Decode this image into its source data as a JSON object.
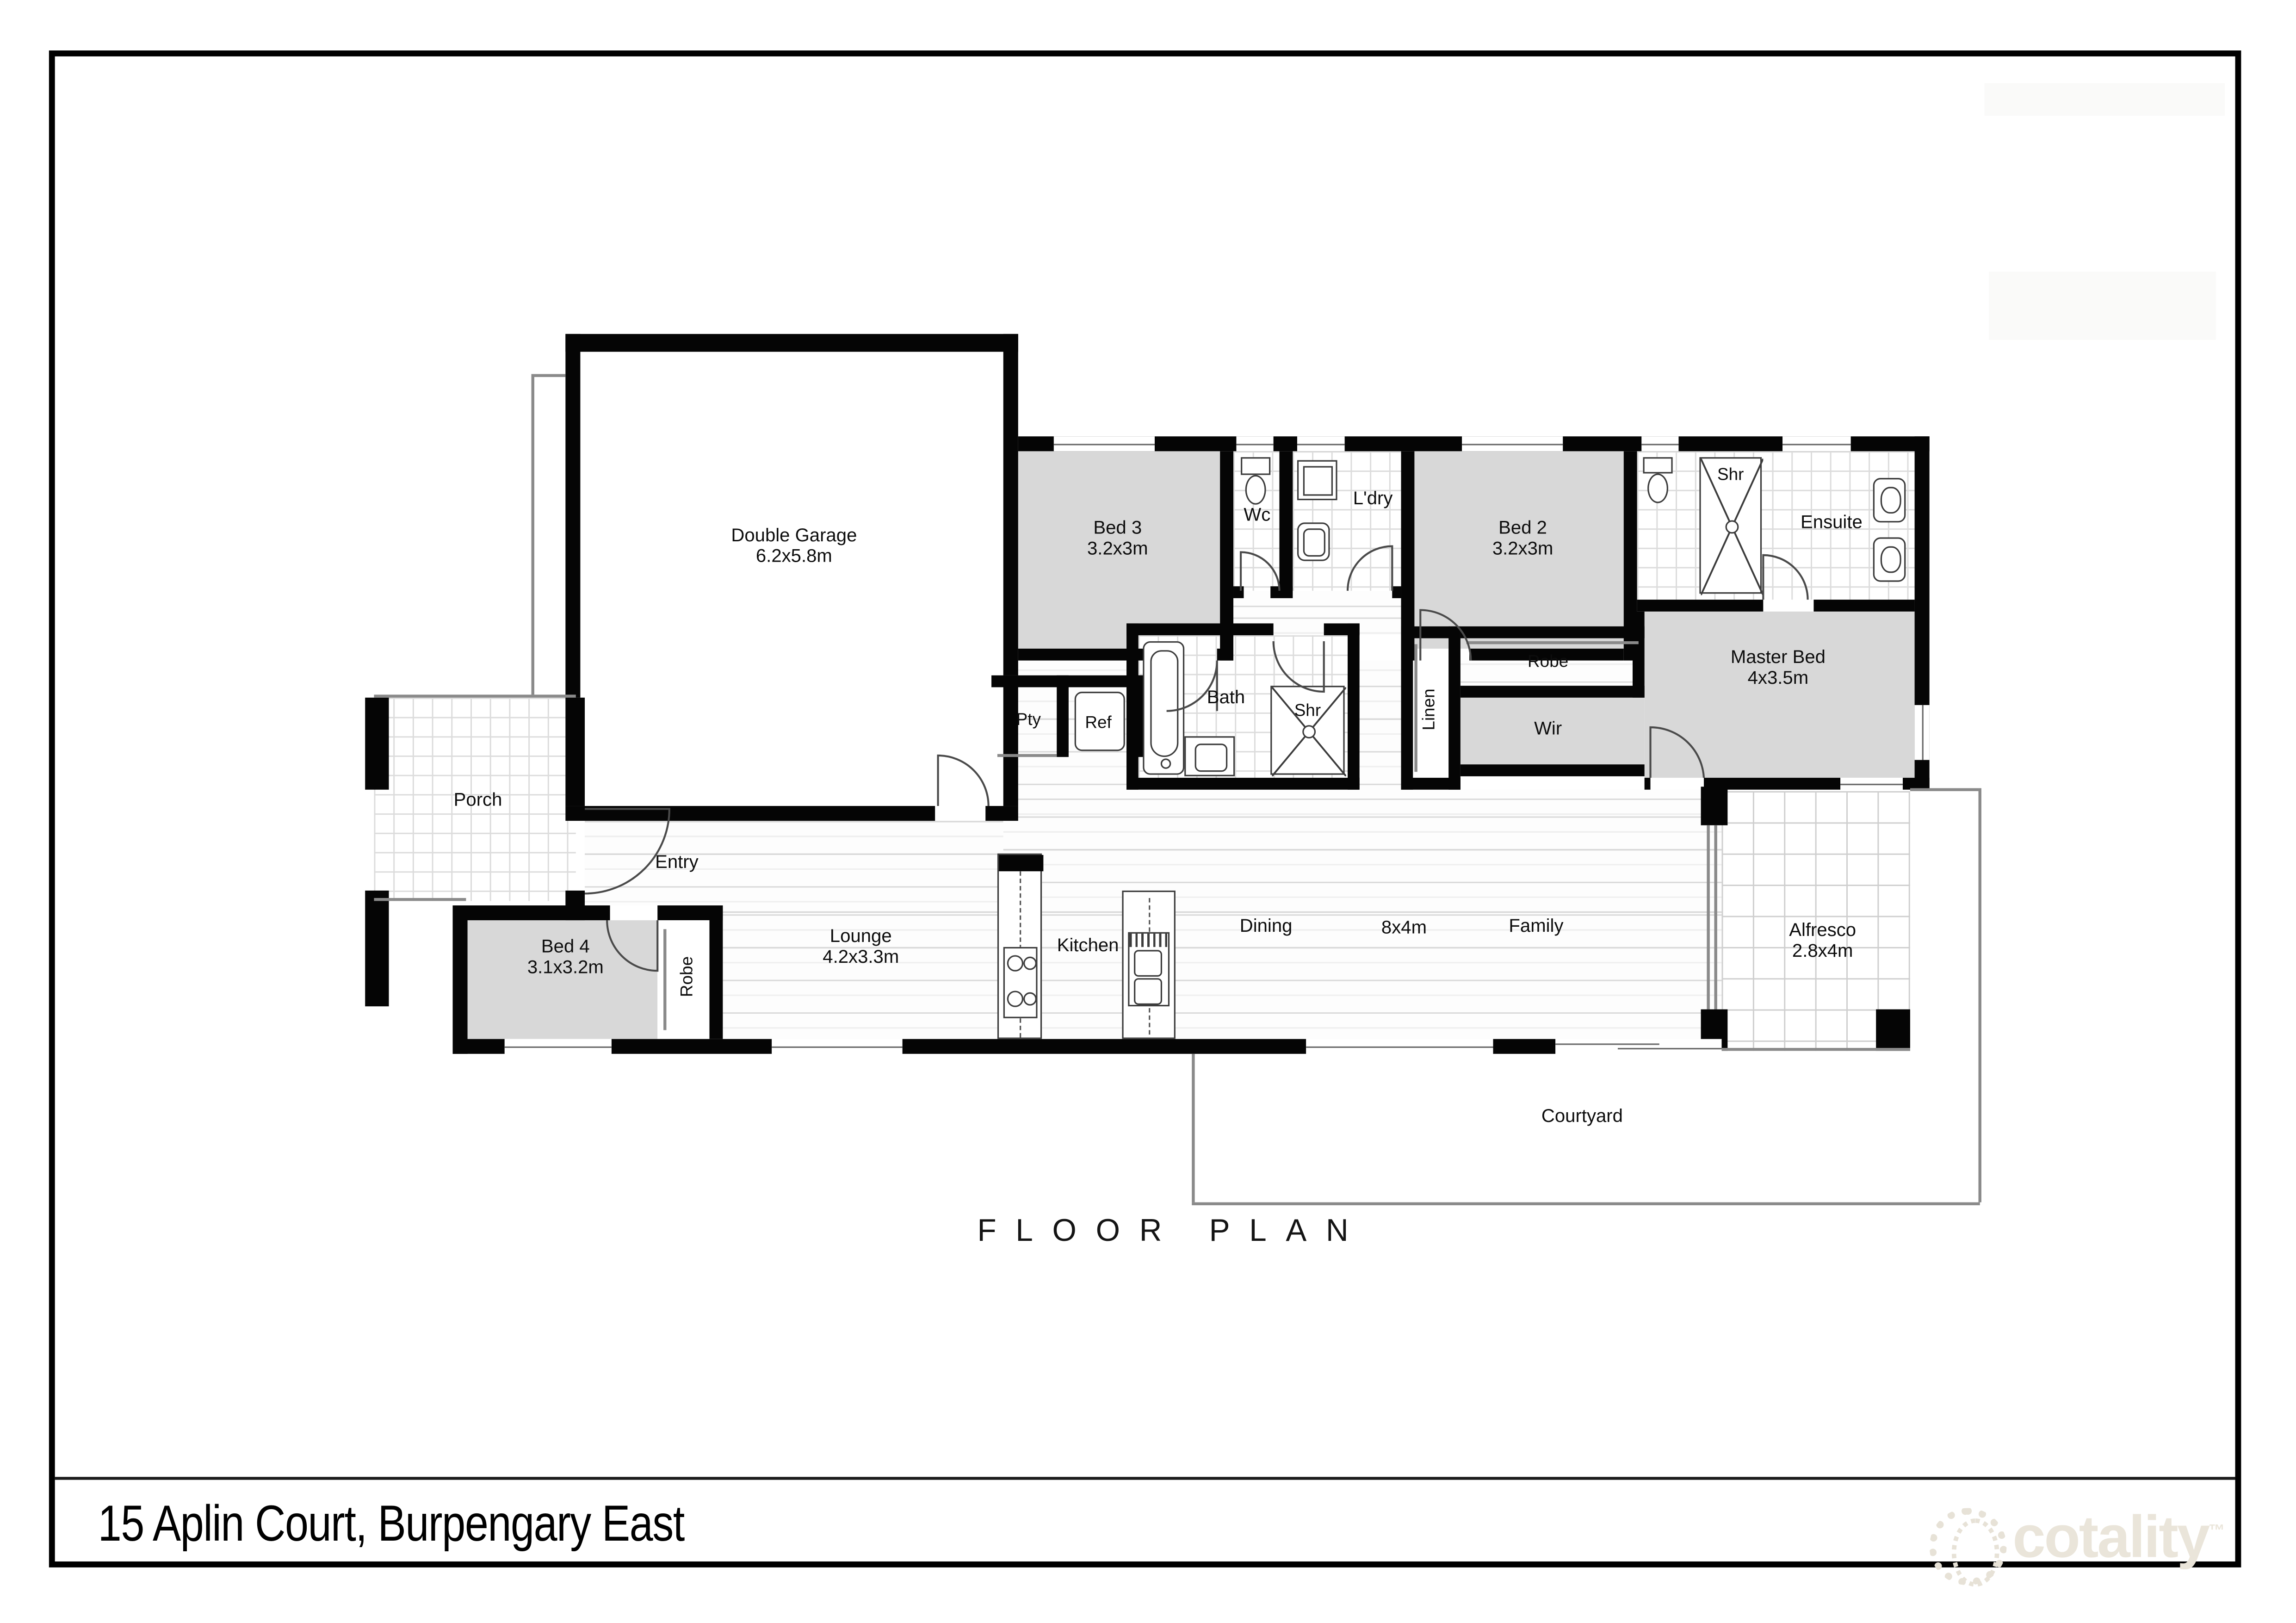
{
  "title_bar": {
    "address": "15 Aplin Court, Burpengary East"
  },
  "plan": {
    "title": "FLOOR PLAN"
  },
  "brand": {
    "name": "cotality",
    "tm": "™"
  },
  "colors": {
    "wall": "#050505",
    "room_fill": "#d8d8d8",
    "accent_logo": "#eae5da"
  },
  "rooms": {
    "garage": {
      "label": "Double Garage",
      "dims": "6.2x5.8m"
    },
    "bed3": {
      "label": "Bed 3",
      "dims": "3.2x3m"
    },
    "wc": {
      "label": "Wc"
    },
    "ldry": {
      "label": "L'dry"
    },
    "bed2": {
      "label": "Bed 2",
      "dims": "3.2x3m"
    },
    "shr_ensuite": {
      "label": "Shr"
    },
    "ensuite": {
      "label": "Ensuite"
    },
    "master": {
      "label": "Master Bed",
      "dims": "4x3.5m"
    },
    "porch": {
      "label": "Porch"
    },
    "entry": {
      "label": "Entry"
    },
    "pty": {
      "label": "Pty"
    },
    "ref": {
      "label": "Ref"
    },
    "bath": {
      "label": "Bath"
    },
    "shr_bath": {
      "label": "Shr"
    },
    "linen": {
      "label": "Linen"
    },
    "robe_master": {
      "label": "Robe"
    },
    "wir": {
      "label": "Wir"
    },
    "bed4": {
      "label": "Bed 4",
      "dims": "3.1x3.2m"
    },
    "robe_bed4": {
      "label": "Robe"
    },
    "lounge": {
      "label": "Lounge",
      "dims": "4.2x3.3m"
    },
    "kitchen": {
      "label": "Kitchen"
    },
    "dining": {
      "label": "Dining"
    },
    "living_dims": {
      "label": "8x4m"
    },
    "family": {
      "label": "Family"
    },
    "alfresco": {
      "label": "Alfresco",
      "dims": "2.8x4m"
    },
    "courtyard": {
      "label": "Courtyard"
    }
  }
}
